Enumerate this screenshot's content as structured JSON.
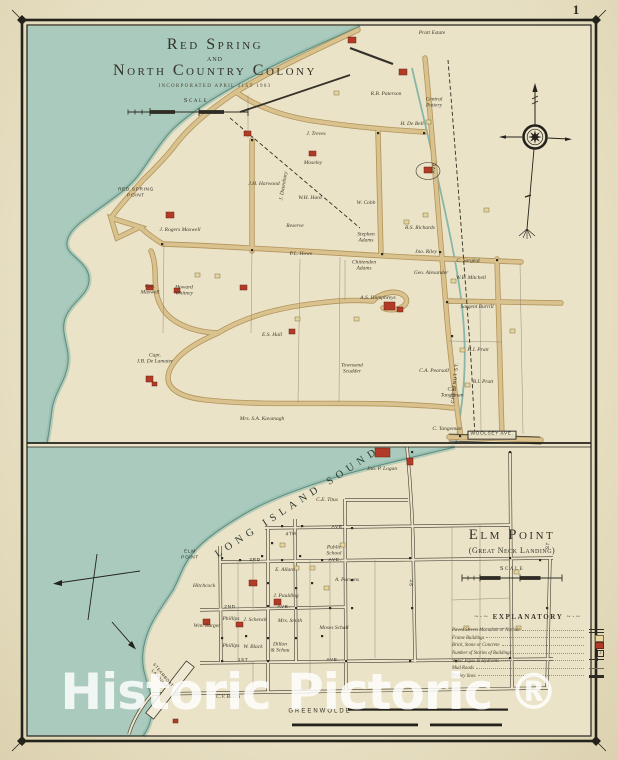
{
  "page": {
    "number": "1",
    "watermark": "Historic Pictoric ®"
  },
  "colors": {
    "paper": "#e7dfc2",
    "land": "#ebe3c8",
    "water": "#a9cabc",
    "water_edge": "#5f8f80",
    "road_fill": "#d9c28e",
    "road_edge": "#b2945c",
    "ink": "#33312a",
    "building_brick": "#b23b27",
    "building_frame": "#e6d59c"
  },
  "top_map": {
    "title": "Red Spring",
    "title_conj": "and",
    "title2": "North Country Colony",
    "subtitle": "INCORPORATED APRIL 21ST 1903",
    "labels": [
      {
        "t": "Pratt Estate",
        "x": 432,
        "y": 33
      },
      {
        "t": "J. Treves",
        "x": 316,
        "y": 134
      },
      {
        "t": "Moseley",
        "x": 313,
        "y": 163
      },
      {
        "t": "R.B. Paterson",
        "x": 386,
        "y": 94
      },
      {
        "t": "Central\nPottery",
        "x": 434,
        "y": 103
      },
      {
        "t": "H. De Bell",
        "x": 412,
        "y": 124
      },
      {
        "t": "J. Dusenbury",
        "x": 284,
        "y": 186,
        "r": -80
      },
      {
        "t": "W.H. Hurd",
        "x": 310,
        "y": 198
      },
      {
        "t": "J.H. Harwood",
        "x": 264,
        "y": 184
      },
      {
        "t": "Reserve",
        "x": 295,
        "y": 226
      },
      {
        "t": "P.L. Howe",
        "x": 301,
        "y": 254
      },
      {
        "t": "W. Cobb",
        "x": 366,
        "y": 203
      },
      {
        "t": "Stephen\nAdams",
        "x": 366,
        "y": 238
      },
      {
        "t": "R.S. Richards",
        "x": 420,
        "y": 228
      },
      {
        "t": "Chittenden\nAdams",
        "x": 364,
        "y": 266
      },
      {
        "t": "Jno. Riley",
        "x": 426,
        "y": 252
      },
      {
        "t": "C. Sargent",
        "x": 468,
        "y": 261
      },
      {
        "t": "Geo. Alexander",
        "x": 431,
        "y": 273
      },
      {
        "t": "W.E. Mitchell",
        "x": 471,
        "y": 278
      },
      {
        "t": "A.S. Humphreys",
        "x": 378,
        "y": 298
      },
      {
        "t": "Sargent Burrill",
        "x": 477,
        "y": 307
      },
      {
        "t": "J. Rogers Maxwell",
        "x": 180,
        "y": 230
      },
      {
        "t": "Gen.\nMaxwell",
        "x": 150,
        "y": 290
      },
      {
        "t": "Howard\nWhitney",
        "x": 184,
        "y": 291
      },
      {
        "t": "E.S. Hall",
        "x": 272,
        "y": 335
      },
      {
        "t": "Capt.\nJ.B. De Lamater",
        "x": 155,
        "y": 359
      },
      {
        "t": "Townsend\nScudder",
        "x": 352,
        "y": 369
      },
      {
        "t": "C.A. Pearsall",
        "x": 434,
        "y": 371
      },
      {
        "t": "H.I. Pratt",
        "x": 478,
        "y": 350
      },
      {
        "t": "B.I. Pratt",
        "x": 483,
        "y": 382
      },
      {
        "t": "C.P.\nTangeman",
        "x": 452,
        "y": 393
      },
      {
        "t": "C. Tangeman",
        "x": 447,
        "y": 429
      },
      {
        "t": "Mrs. S.A. Kavanagh",
        "x": 262,
        "y": 419
      },
      {
        "t": "RED SPRING\nPOINT",
        "x": 136,
        "y": 193,
        "cls": "street"
      },
      {
        "t": "WOOLSEY AVE.",
        "x": 492,
        "y": 435,
        "cls": "street box"
      },
      {
        "t": "AVE.",
        "x": 435,
        "y": 167,
        "r": -84,
        "cls": "street"
      },
      {
        "t": "CHESTNUT ST.",
        "x": 456,
        "y": 383,
        "r": -84,
        "cls": "street"
      },
      {
        "t": "Scale",
        "x": 196,
        "y": 101,
        "cls": "scale"
      }
    ]
  },
  "bottom_map": {
    "title": "Elm Point",
    "subtitle": "(Great Neck Landing)",
    "labels": [
      {
        "t": "LONG ISLAND SOUND",
        "x": 298,
        "y": 503,
        "r": -33,
        "cls": "sound",
        "s": 10.5,
        "ls": 5
      },
      {
        "t": "ELM\nPOINT",
        "x": 190,
        "y": 555,
        "cls": "street"
      },
      {
        "t": "Jno. P. Logan",
        "x": 382,
        "y": 469
      },
      {
        "t": "C.E. Titus",
        "x": 327,
        "y": 500
      },
      {
        "t": "Public\nSchool",
        "x": 334,
        "y": 551
      },
      {
        "t": "A. Parsons",
        "x": 347,
        "y": 580
      },
      {
        "t": "E. Allard",
        "x": 285,
        "y": 570
      },
      {
        "t": "J. Paulding",
        "x": 286,
        "y": 596
      },
      {
        "t": "Hitchcock",
        "x": 204,
        "y": 586
      },
      {
        "t": "Wm. Burger",
        "x": 207,
        "y": 626
      },
      {
        "t": "Phillips",
        "x": 231,
        "y": 619
      },
      {
        "t": "J. Schenck",
        "x": 255,
        "y": 620
      },
      {
        "t": "Mrs. Smith",
        "x": 290,
        "y": 621
      },
      {
        "t": "Moses Schall",
        "x": 334,
        "y": 628
      },
      {
        "t": "Phillips",
        "x": 231,
        "y": 646
      },
      {
        "t": "W. Black",
        "x": 253,
        "y": 647
      },
      {
        "t": "Dillon\n& Schau",
        "x": 280,
        "y": 648
      },
      {
        "t": "C.V. Busch",
        "x": 228,
        "y": 697
      },
      {
        "t": "4TH",
        "x": 291,
        "y": 535,
        "cls": "street",
        "r": -3
      },
      {
        "t": "AVE.",
        "x": 338,
        "y": 528,
        "cls": "street"
      },
      {
        "t": "3RD",
        "x": 255,
        "y": 561,
        "cls": "street"
      },
      {
        "t": "AVE.",
        "x": 335,
        "y": 561,
        "cls": "street"
      },
      {
        "t": "2ND",
        "x": 230,
        "y": 608,
        "cls": "street"
      },
      {
        "t": "AVE.",
        "x": 284,
        "y": 608,
        "cls": "street"
      },
      {
        "t": "1ST",
        "x": 243,
        "y": 661,
        "cls": "street"
      },
      {
        "t": "AVE.",
        "x": 333,
        "y": 661,
        "cls": "street"
      },
      {
        "t": "ST.",
        "x": 549,
        "y": 545,
        "r": -86,
        "cls": "street"
      },
      {
        "t": "ST.",
        "x": 413,
        "y": 582,
        "r": -86,
        "cls": "street"
      },
      {
        "t": "GREENWOLDE",
        "x": 320,
        "y": 712,
        "cls": "street",
        "s": 6,
        "ls": 2
      },
      {
        "t": "STEAMBOAT\nLANDING",
        "x": 161,
        "y": 677,
        "r": 50,
        "cls": "street",
        "s": 4
      },
      {
        "t": "Scale",
        "x": 512,
        "y": 569,
        "cls": "scale"
      }
    ]
  },
  "legend": {
    "title": "EXPLANATORY",
    "items": [
      {
        "label": "Paved Streets Macadam or Asphalt",
        "symbol": "paved"
      },
      {
        "label": "Frame Buildings",
        "symbol": "frame"
      },
      {
        "label": "Brick, Stone or Concrete",
        "symbol": "brick"
      },
      {
        "label": "Number of Stories of Buildings",
        "symbol": "stories",
        "glyph": "2"
      },
      {
        "label": "Water Pipes & Hydrants",
        "symbol": "water"
      },
      {
        "label": "Mud Roads",
        "symbol": "mud"
      },
      {
        "label": "Trolley lines",
        "symbol": "trolley"
      }
    ]
  }
}
